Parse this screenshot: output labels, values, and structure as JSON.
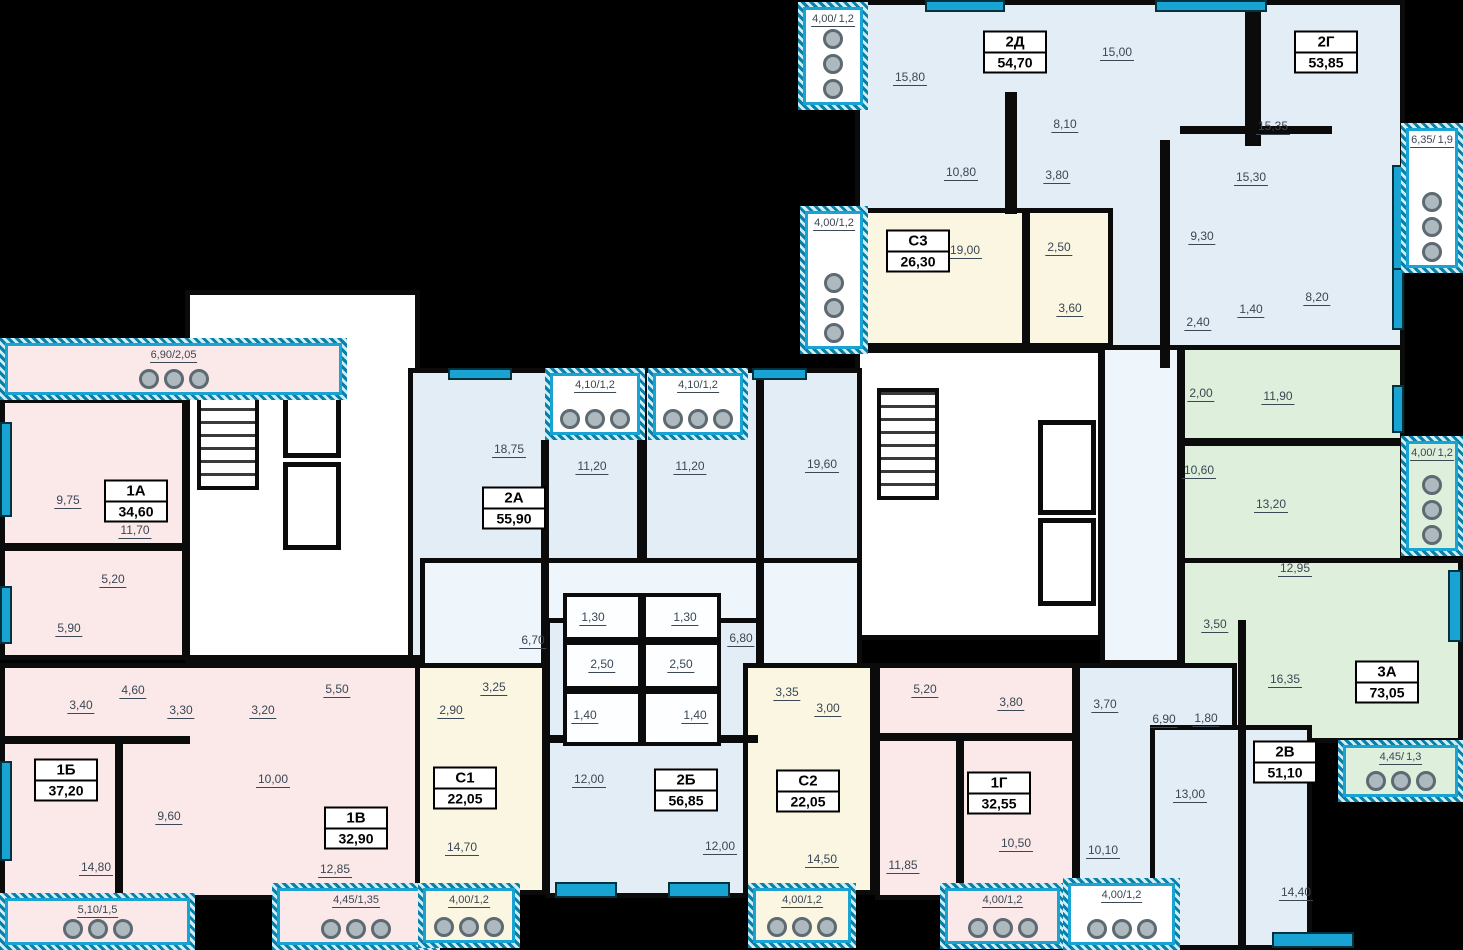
{
  "colors": {
    "blue": "#e3edf6",
    "paleblue": "#eef5fb",
    "pink": "#fbe8e8",
    "cream": "#faf6e2",
    "green": "#def0dc",
    "accent": "#18a3d2",
    "ink": "#3a4754",
    "wall": "#0b0b0b"
  },
  "regions": [
    {
      "n": "section-top-2d-2g",
      "x": 855,
      "y": 0,
      "w": 550,
      "h": 368,
      "f": "blue"
    },
    {
      "n": "apartment-s3",
      "x": 855,
      "y": 208,
      "w": 258,
      "h": 140,
      "f": "cream"
    },
    {
      "n": "stair-core-left",
      "x": 185,
      "y": 290,
      "w": 235,
      "h": 373,
      "f": "white"
    },
    {
      "n": "stair-core-right",
      "x": 855,
      "y": 348,
      "w": 248,
      "h": 292,
      "f": "white"
    },
    {
      "n": "corridor-right",
      "x": 1100,
      "y": 345,
      "w": 82,
      "h": 320,
      "f": "paleblue"
    },
    {
      "n": "apartment-3a-upper",
      "x": 1180,
      "y": 345,
      "w": 225,
      "h": 302,
      "f": "green"
    },
    {
      "n": "apartment-3a-lower",
      "x": 1180,
      "y": 558,
      "w": 283,
      "h": 185,
      "f": "green"
    },
    {
      "n": "apartment-1a",
      "x": 0,
      "y": 398,
      "w": 187,
      "h": 262,
      "f": "pink"
    },
    {
      "n": "apartment-1b-1v-band",
      "x": 0,
      "y": 663,
      "w": 420,
      "h": 237,
      "f": "pink"
    },
    {
      "n": "apartment-2a",
      "x": 408,
      "y": 368,
      "w": 234,
      "h": 300,
      "f": "blue"
    },
    {
      "n": "apartment-2b-upper",
      "x": 642,
      "y": 368,
      "w": 220,
      "h": 300,
      "f": "blue"
    },
    {
      "n": "corridor-middle",
      "x": 420,
      "y": 558,
      "w": 442,
      "h": 182,
      "f": "paleblue"
    },
    {
      "n": "apartment-2b-lower",
      "x": 545,
      "y": 618,
      "w": 217,
      "h": 280,
      "f": "blue"
    },
    {
      "n": "apartment-s1",
      "x": 415,
      "y": 663,
      "w": 132,
      "h": 232,
      "f": "cream"
    },
    {
      "n": "apartment-s2",
      "x": 743,
      "y": 663,
      "w": 132,
      "h": 232,
      "f": "cream"
    },
    {
      "n": "apartment-1g",
      "x": 875,
      "y": 663,
      "w": 202,
      "h": 237,
      "f": "pink"
    },
    {
      "n": "apartment-2v-hall",
      "x": 1075,
      "y": 663,
      "w": 162,
      "h": 220,
      "f": "blue"
    },
    {
      "n": "apartment-2v-rooms",
      "x": 1150,
      "y": 725,
      "w": 162,
      "h": 225,
      "f": "blue"
    }
  ],
  "small_rooms": [
    {
      "x": 563,
      "y": 593,
      "w": 79,
      "h": 48
    },
    {
      "x": 642,
      "y": 593,
      "w": 79,
      "h": 48
    },
    {
      "x": 563,
      "y": 641,
      "w": 79,
      "h": 49
    },
    {
      "x": 642,
      "y": 641,
      "w": 79,
      "h": 49
    },
    {
      "x": 563,
      "y": 690,
      "w": 79,
      "h": 56
    },
    {
      "x": 642,
      "y": 690,
      "w": 79,
      "h": 56
    }
  ],
  "walls": [
    [
      1245,
      0,
      16,
      146
    ],
    [
      1160,
      140,
      10,
      228
    ],
    [
      1180,
      126,
      152,
      8
    ],
    [
      1005,
      92,
      12,
      122
    ],
    [
      1022,
      208,
      8,
      140
    ],
    [
      1180,
      438,
      225,
      8
    ],
    [
      1238,
      620,
      8,
      330
    ],
    [
      548,
      735,
      210,
      8
    ],
    [
      0,
      543,
      187,
      8
    ],
    [
      0,
      736,
      190,
      8
    ],
    [
      115,
      738,
      8,
      158
    ],
    [
      956,
      735,
      8,
      162
    ],
    [
      756,
      368,
      8,
      295
    ],
    [
      541,
      440,
      8,
      228
    ],
    [
      185,
      655,
      235,
      8
    ],
    [
      875,
      733,
      202,
      8
    ]
  ],
  "windows": [
    [
      925,
      0,
      80,
      12
    ],
    [
      1155,
      0,
      112,
      12
    ],
    [
      1392,
      165,
      12,
      118
    ],
    [
      1392,
      268,
      12,
      62
    ],
    [
      1392,
      385,
      12,
      48
    ],
    [
      1448,
      570,
      14,
      72
    ],
    [
      0,
      422,
      12,
      95
    ],
    [
      0,
      586,
      12,
      58
    ],
    [
      0,
      761,
      12,
      100
    ],
    [
      448,
      368,
      64,
      12
    ],
    [
      752,
      368,
      55,
      12
    ],
    [
      555,
      882,
      62,
      16
    ],
    [
      668,
      882,
      62,
      16
    ],
    [
      1272,
      932,
      82,
      16
    ]
  ],
  "stairs": [
    [
      197,
      378,
      62,
      112
    ],
    [
      877,
      388,
      62,
      112
    ]
  ],
  "elevators": [
    [
      283,
      370,
      58,
      88
    ],
    [
      283,
      462,
      58,
      88
    ],
    [
      1038,
      420,
      58,
      95
    ],
    [
      1038,
      518,
      58,
      88
    ]
  ],
  "balconies": [
    {
      "t": [
        "4,00/",
        "1,2"
      ],
      "x": 798,
      "y": 2,
      "w": 70,
      "h": 108,
      "f": "white",
      "o": "v"
    },
    {
      "t": [
        "4,00/1,2"
      ],
      "x": 800,
      "y": 206,
      "w": 68,
      "h": 148,
      "f": "white",
      "o": "v"
    },
    {
      "t": [
        "6,35/",
        "1,9"
      ],
      "x": 1401,
      "y": 123,
      "w": 62,
      "h": 150,
      "f": "white",
      "o": "v"
    },
    {
      "t": [
        "4,00/",
        "1,2"
      ],
      "x": 1401,
      "y": 436,
      "w": 62,
      "h": 120,
      "f": "green",
      "o": "v"
    },
    {
      "t": [
        "4,45/",
        "1,3"
      ],
      "x": 1338,
      "y": 740,
      "w": 125,
      "h": 62,
      "f": "green",
      "o": "h"
    },
    {
      "t": [
        "6,90/2,05"
      ],
      "x": 0,
      "y": 338,
      "w": 347,
      "h": 62,
      "f": "pink",
      "o": "h"
    },
    {
      "t": [
        "4,10/1,2"
      ],
      "x": 545,
      "y": 368,
      "w": 100,
      "h": 72,
      "f": "white",
      "o": "h"
    },
    {
      "t": [
        "4,10/1,2"
      ],
      "x": 648,
      "y": 368,
      "w": 100,
      "h": 72,
      "f": "white",
      "o": "h"
    },
    {
      "t": [
        "5,10/1,5"
      ],
      "x": 0,
      "y": 893,
      "w": 195,
      "h": 57,
      "f": "pink",
      "o": "h"
    },
    {
      "t": [
        "4,45/1,35"
      ],
      "x": 272,
      "y": 883,
      "w": 168,
      "h": 67,
      "f": "pink",
      "o": "h"
    },
    {
      "t": [
        "4,00/1,2"
      ],
      "x": 418,
      "y": 883,
      "w": 102,
      "h": 65,
      "f": "cream",
      "o": "h"
    },
    {
      "t": [
        "4,00/1,2"
      ],
      "x": 748,
      "y": 883,
      "w": 108,
      "h": 65,
      "f": "cream",
      "o": "h"
    },
    {
      "t": [
        "4,00/1,2"
      ],
      "x": 940,
      "y": 883,
      "w": 125,
      "h": 66,
      "f": "pink",
      "o": "h"
    },
    {
      "t": [
        "4,00/1,2"
      ],
      "x": 1063,
      "y": 878,
      "w": 117,
      "h": 72,
      "f": "white",
      "o": "h"
    }
  ],
  "apartments": [
    {
      "code": "2Д",
      "area": "54,70",
      "x": 1015,
      "y": 52
    },
    {
      "code": "2Г",
      "area": "53,85",
      "x": 1326,
      "y": 52
    },
    {
      "code": "С3",
      "area": "26,30",
      "x": 918,
      "y": 251
    },
    {
      "code": "1А",
      "area": "34,60",
      "x": 136,
      "y": 501
    },
    {
      "code": "2А",
      "area": "55,90",
      "x": 514,
      "y": 508
    },
    {
      "code": "3А",
      "area": "73,05",
      "x": 1387,
      "y": 682
    },
    {
      "code": "2В",
      "area": "51,10",
      "x": 1285,
      "y": 762
    },
    {
      "code": "1Б",
      "area": "37,20",
      "x": 66,
      "y": 780
    },
    {
      "code": "1В",
      "area": "32,90",
      "x": 356,
      "y": 828
    },
    {
      "code": "С1",
      "area": "22,05",
      "x": 465,
      "y": 788
    },
    {
      "code": "2Б",
      "area": "56,85",
      "x": 686,
      "y": 790
    },
    {
      "code": "С2",
      "area": "22,05",
      "x": 808,
      "y": 791
    },
    {
      "code": "1Г",
      "area": "32,55",
      "x": 999,
      "y": 793
    }
  ],
  "rooms": [
    {
      "t": "15,80",
      "x": 910,
      "y": 78
    },
    {
      "t": "15,00",
      "x": 1117,
      "y": 53
    },
    {
      "t": "10,80",
      "x": 961,
      "y": 173
    },
    {
      "t": "8,10",
      "x": 1065,
      "y": 125
    },
    {
      "t": "3,80",
      "x": 1057,
      "y": 176
    },
    {
      "t": "15,35",
      "x": 1273,
      "y": 127
    },
    {
      "t": "15,30",
      "x": 1251,
      "y": 178
    },
    {
      "t": "9,30",
      "x": 1202,
      "y": 237
    },
    {
      "t": "8,20",
      "x": 1317,
      "y": 298
    },
    {
      "t": "2,40",
      "x": 1198,
      "y": 323
    },
    {
      "t": "1,40",
      "x": 1251,
      "y": 310
    },
    {
      "t": "19,00",
      "x": 965,
      "y": 251
    },
    {
      "t": "2,50",
      "x": 1059,
      "y": 248
    },
    {
      "t": "3,60",
      "x": 1070,
      "y": 309
    },
    {
      "t": "2,00",
      "x": 1201,
      "y": 394
    },
    {
      "t": "11,90",
      "x": 1278,
      "y": 397
    },
    {
      "t": "10,60",
      "x": 1199,
      "y": 471
    },
    {
      "t": "13,20",
      "x": 1271,
      "y": 505
    },
    {
      "t": "12,95",
      "x": 1295,
      "y": 569
    },
    {
      "t": "3,50",
      "x": 1215,
      "y": 625
    },
    {
      "t": "16,35",
      "x": 1285,
      "y": 680
    },
    {
      "t": "1,80",
      "x": 1206,
      "y": 719
    },
    {
      "t": "9,75",
      "x": 68,
      "y": 501
    },
    {
      "t": "11,70",
      "x": 135,
      "y": 531
    },
    {
      "t": "5,20",
      "x": 113,
      "y": 580
    },
    {
      "t": "5,90",
      "x": 69,
      "y": 629
    },
    {
      "t": "18,75",
      "x": 509,
      "y": 450
    },
    {
      "t": "11,20",
      "x": 592,
      "y": 467
    },
    {
      "t": "11,20",
      "x": 690,
      "y": 467
    },
    {
      "t": "19,60",
      "x": 822,
      "y": 465
    },
    {
      "t": "6,70",
      "x": 533,
      "y": 641
    },
    {
      "t": "1,30",
      "x": 593,
      "y": 618
    },
    {
      "t": "1,30",
      "x": 685,
      "y": 618
    },
    {
      "t": "2,50",
      "x": 602,
      "y": 665
    },
    {
      "t": "2,50",
      "x": 681,
      "y": 665
    },
    {
      "t": "6,80",
      "x": 741,
      "y": 639
    },
    {
      "t": "1,40",
      "x": 585,
      "y": 716
    },
    {
      "t": "1,40",
      "x": 695,
      "y": 716
    },
    {
      "t": "3,40",
      "x": 81,
      "y": 706
    },
    {
      "t": "4,60",
      "x": 133,
      "y": 691
    },
    {
      "t": "3,30",
      "x": 181,
      "y": 711
    },
    {
      "t": "9,60",
      "x": 169,
      "y": 817
    },
    {
      "t": "14,80",
      "x": 96,
      "y": 868
    },
    {
      "t": "3,20",
      "x": 263,
      "y": 711
    },
    {
      "t": "5,50",
      "x": 337,
      "y": 690
    },
    {
      "t": "10,00",
      "x": 273,
      "y": 780
    },
    {
      "t": "12,85",
      "x": 335,
      "y": 870
    },
    {
      "t": "3,25",
      "x": 494,
      "y": 688
    },
    {
      "t": "2,90",
      "x": 451,
      "y": 711
    },
    {
      "t": "14,70",
      "x": 462,
      "y": 848
    },
    {
      "t": "12,00",
      "x": 589,
      "y": 780
    },
    {
      "t": "12,00",
      "x": 720,
      "y": 847
    },
    {
      "t": "3,35",
      "x": 787,
      "y": 693
    },
    {
      "t": "3,00",
      "x": 828,
      "y": 709
    },
    {
      "t": "14,50",
      "x": 822,
      "y": 860
    },
    {
      "t": "5,20",
      "x": 925,
      "y": 690
    },
    {
      "t": "3,80",
      "x": 1011,
      "y": 703
    },
    {
      "t": "10,50",
      "x": 1016,
      "y": 844
    },
    {
      "t": "11,85",
      "x": 903,
      "y": 866
    },
    {
      "t": "3,70",
      "x": 1105,
      "y": 705
    },
    {
      "t": "6,90",
      "x": 1164,
      "y": 720
    },
    {
      "t": "13,00",
      "x": 1190,
      "y": 795
    },
    {
      "t": "10,10",
      "x": 1103,
      "y": 851
    },
    {
      "t": "14,40",
      "x": 1296,
      "y": 893
    }
  ]
}
